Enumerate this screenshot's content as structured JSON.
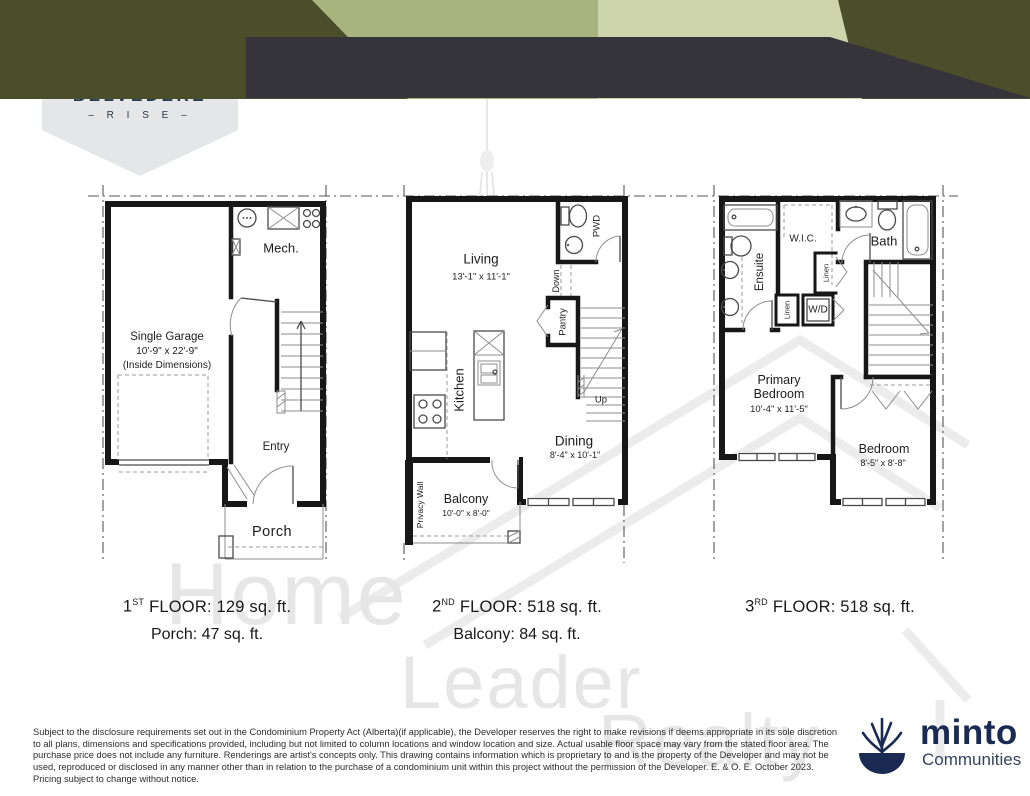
{
  "colors": {
    "olive": "#4a4e2b",
    "sage": "#a9b37d",
    "sage_light": "#ced5ac",
    "charcoal": "#34343a",
    "navy_logo": "#27394d",
    "minto_navy": "#1b2a52",
    "shield_gray": "#e5e6e8"
  },
  "branding": {
    "community": "BELVEDERE",
    "community_tagline": "– R I S E –",
    "developer": "minto",
    "developer_division": "Communities"
  },
  "header": {
    "model_name": "BELLHAVEN",
    "model_type": "BACK-TO-BACK TOWNHOME",
    "spec_width": "20’ wide",
    "spec_area": "1,165  sq. ft.",
    "spec_beds": "2 bed",
    "spec_baths": "2.5 bath"
  },
  "plans": {
    "floor1": {
      "rooms": {
        "mech": "Mech.",
        "garage_line1": "Single Garage",
        "garage_line2": "10'-9\" x 22'-9\"",
        "garage_line3": "(Inside Dimensions)",
        "entry": "Entry",
        "porch": "Porch"
      },
      "caption": {
        "num": "1",
        "sup": "ST",
        "rest": "FLOOR: 129  sq. ft.",
        "line2": "Porch: 47 sq. ft."
      }
    },
    "floor2": {
      "rooms": {
        "living": "Living",
        "living_dims": "13'-1\" x 11'-1\"",
        "pwd": "PWD",
        "down": "Down",
        "pantry": "Pantry",
        "up": "Up",
        "kitchen": "Kitchen",
        "dining": "Dining",
        "dining_dims": "8'-4\" x 10'-1\"",
        "balcony": "Balcony",
        "balcony_dims": "10'-0\" x 8'-0\"",
        "privacy_wall": "Privacy Wall"
      },
      "caption": {
        "num": "2",
        "sup": "ND",
        "rest": "FLOOR: 518  sq. ft.",
        "line2": "Balcony: 84 sq. ft."
      }
    },
    "floor3": {
      "rooms": {
        "ensuite": "Ensuite",
        "wic": "W.I.C.",
        "bath": "Bath",
        "linen_a": "Linen",
        "linen_b": "Linen",
        "wd": "W/D",
        "primary_line1": "Primary",
        "primary_line2": "Bedroom",
        "primary_dims": "10'-4\" x 11'-5\"",
        "bedroom": "Bedroom",
        "bedroom_dims": "8'-5\" x 8'-8\""
      },
      "caption": {
        "num": "3",
        "sup": "RD",
        "rest": "FLOOR: 518  sq. ft."
      }
    }
  },
  "watermark": {
    "line1": "Home",
    "line2": "Leader",
    "line3": "Realty"
  },
  "disclaimer": "Subject to the disclosure requirements set out in the Condominium Property Act (Alberta)(if applicable), the Developer reserves the right to make revisions if deems appropriate in its sole discretion to all plans, dimensions and specifications provided, including but not limited to column locations and window location and size. Actual usable floor space may vary from the stated floor area. The purchase price does not include any furniture. Renderings are artist's concepts only. This drawing contains information which is proprietary to and is the property of the Developer and may not be used, reproduced or disclosed in any manner other than in relation to the purchase of a condominium unit within this project without the permission of the Developer. E. & O. E. October 2023. Pricing subject to change without notice."
}
